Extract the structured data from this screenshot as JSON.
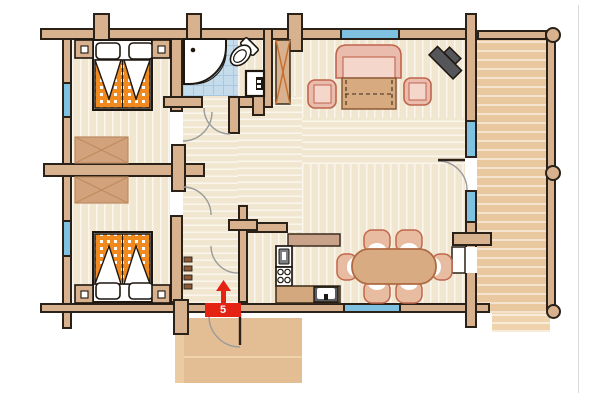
{
  "meta": {
    "type": "floor-plan",
    "subject": "log cabin house plan",
    "canvas": "600x400"
  },
  "entrance": {
    "label": "5",
    "arrow_direction": "up"
  },
  "rooms": [
    {
      "id": "bedroom-1",
      "position": "top-left",
      "furniture": [
        "double-bed",
        "two-pillows",
        "two-nightstands",
        "wardrobe"
      ],
      "windows": 1
    },
    {
      "id": "bathroom",
      "position": "top-center",
      "floor": "blue-tile",
      "furniture": [
        "corner-shower",
        "toilet",
        "washbasin"
      ]
    },
    {
      "id": "bedroom-2",
      "position": "bottom-left",
      "furniture": [
        "double-bed",
        "two-pillows",
        "two-nightstands",
        "wardrobe"
      ],
      "windows": 1
    },
    {
      "id": "hallway",
      "position": "center",
      "furniture": [
        "coat-hooks"
      ],
      "doors_to": [
        "bedroom-1",
        "bedroom-2",
        "bathroom",
        "kitchen",
        "entrance"
      ]
    },
    {
      "id": "living-room",
      "position": "top-right",
      "furniture": [
        "sofa",
        "coffee-table",
        "armchair-left",
        "armchair-right",
        "tv",
        "tall-cabinet"
      ],
      "windows": 2
    },
    {
      "id": "kitchen",
      "position": "bottom-center",
      "furniture": [
        "upper-counter",
        "oven",
        "stove-4-burners",
        "lower-counter",
        "sink"
      ]
    },
    {
      "id": "dining-area",
      "position": "bottom-right",
      "furniture": [
        "oval-table",
        "six-chairs"
      ],
      "windows": 2
    },
    {
      "id": "terrace",
      "position": "right",
      "features": [
        "plank-floor",
        "railing",
        "three-round-posts",
        "steps"
      ]
    },
    {
      "id": "entrance-porch",
      "position": "bottom",
      "features": [
        "steps"
      ]
    }
  ],
  "palette": {
    "wall": "#d8b28e",
    "outline": "#2a2118",
    "floor": "#f1e6cf",
    "tile_blue": "#c5dcec",
    "window_blue": "#7ec1e0",
    "accent_red": "#e42313",
    "blanket_orange": "#f08a1f",
    "upholstery_pink": "#eabcae",
    "wood_tan": "#d8ab83",
    "tv_gray": "#55565a"
  }
}
